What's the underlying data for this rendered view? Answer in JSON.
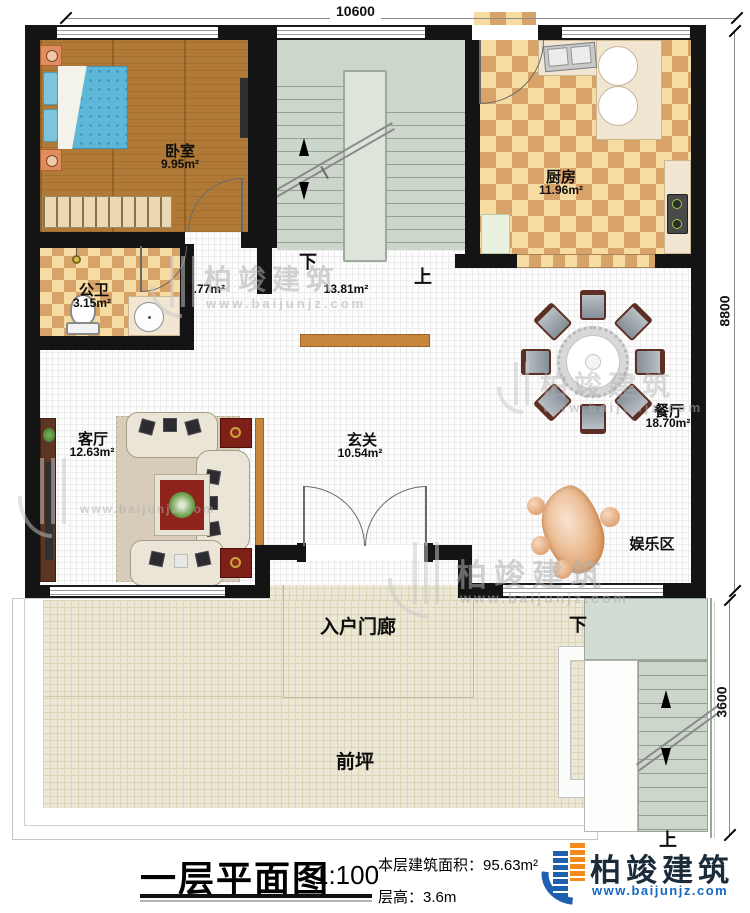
{
  "plan": {
    "title": "一层平面图",
    "scale": "1:100",
    "area_label": "本层建筑面积：",
    "area_value": "95.63m²",
    "height_label": "层高：",
    "height_value": "3.6m"
  },
  "brand": {
    "name": "柏竣建筑",
    "website": "www.baijunjz.com"
  },
  "dims": {
    "top": "10600",
    "right": "8800",
    "stair": "3600"
  },
  "rooms": {
    "bedroom": {
      "name": "卧室",
      "area": "9.95m²"
    },
    "kitchen": {
      "name": "厨房",
      "area": "11.96m²"
    },
    "bath": {
      "name": "公卫",
      "area": "3.15m²"
    },
    "living": {
      "name": "客厅",
      "area": "12.63m²"
    },
    "foyer": {
      "name": "玄关",
      "area": "10.54m²"
    },
    "dining": {
      "name": "餐厅",
      "area": "18.70m²"
    },
    "fun": {
      "name": "娱乐区"
    },
    "porch": {
      "name": "入户门廊"
    },
    "yard": {
      "name": "前坪"
    },
    "stair_small_area": "1.77m²",
    "stair_main_area": "13.81m²"
  },
  "stair": {
    "down": "下",
    "up": "上"
  }
}
